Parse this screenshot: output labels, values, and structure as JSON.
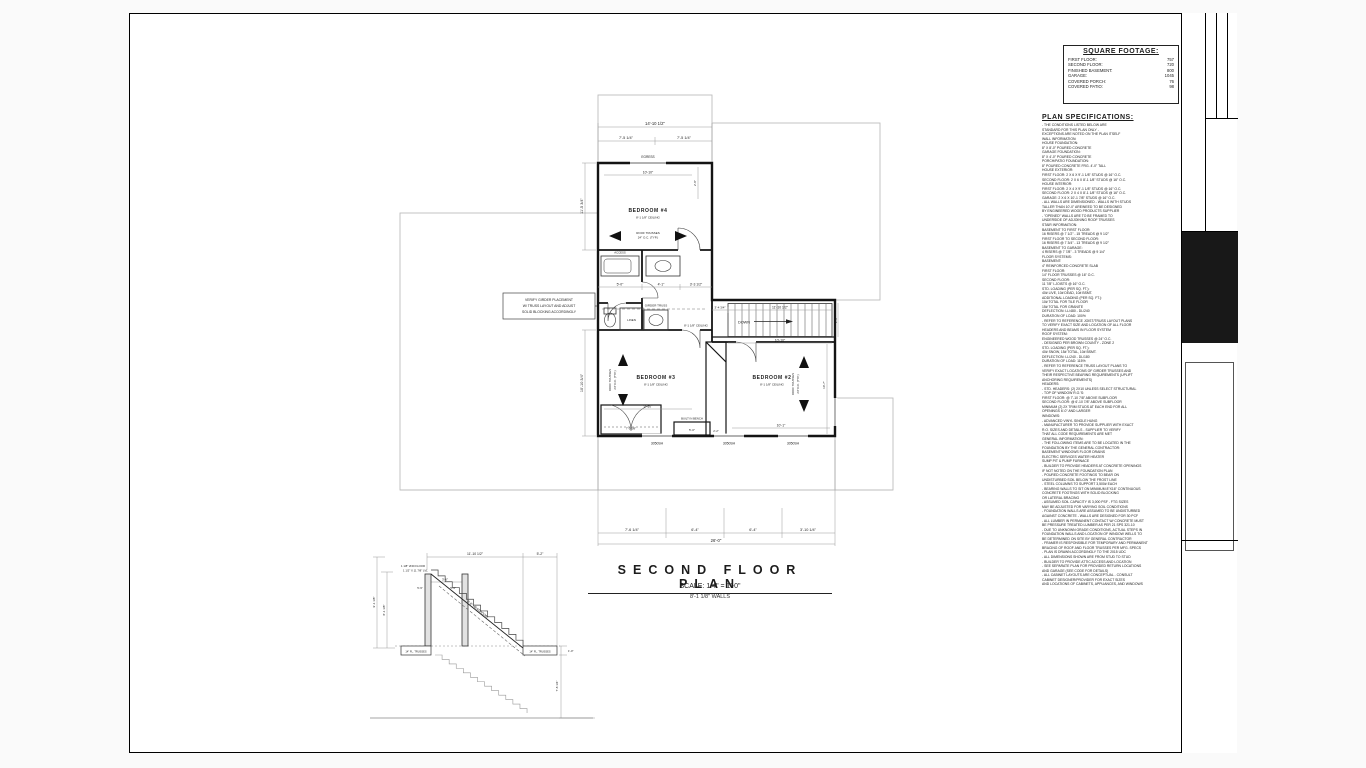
{
  "sheet": {
    "floor_plan_title": "SECOND FLOOR PLAN",
    "scale_line": "SCALE: 1/4\" = 1'-0\"",
    "walls_line": "8'-1 1/8\" WALLS"
  },
  "square_footage": {
    "title": "SQUARE FOOTAGE:",
    "rows": [
      {
        "label": "FIRST FLOOR:",
        "value": "757"
      },
      {
        "label": "SECOND FLOOR:",
        "value": "720"
      },
      {
        "label": "FINISHED BASEMENT:",
        "value": "800"
      },
      {
        "label": "GARAGE:",
        "value": "1045"
      },
      {
        "label": "COVERED PORCH:",
        "value": "76"
      },
      {
        "label": "COVERED PATIO:",
        "value": "98"
      }
    ]
  },
  "plan_specifications": {
    "title": "PLAN SPECIFICATIONS:",
    "lines": [
      "- THE CONDITIONS LISTED BELOW ARE",
      "  STANDARD FOR THIS PLAN ONLY -",
      "  EXCEPTIONS ARE NOTED ON THE PLAN ITSELF",
      "WALL INFORMATION:",
      "HOUSE FOUNDATION:",
      "   8\" X 8'-0\" POURED CONCRETE",
      "GARAGE FOUNDATION:",
      "   8\" X 4'-0\" POURED CONCRETE",
      "PORCH/PATIO FOUNDATION:",
      "   8\" POURED CONCRETE FRG. 4'-0\" TALL",
      "HOUSE EXTERIOR:",
      "   FIRST FLOOR: 2 X 6 X 9'-1 1/8\" STUDS @ 16\" O.C.",
      "   SECOND FLOOR: 2 X 6 X 8'-1 1/8\" STUDS @ 16\" O.C.",
      "HOUSE INTERIOR:",
      "   FIRST FLOOR: 2 X 4 X 9'-1 1/8\" STUDS @ 16\" O.C.",
      "   SECOND FLOOR: 2 X 4 X 8'-1 1/8\" STUDS @ 16\" O.C.",
      "GARAGE: 2 X 6 X 10'-1 7/8\" STUDS @ 16\" O.C.",
      "- ALL WALLS ARE DIMENSIONED - WALLS WITH STUDS",
      "  TALLER THAN 10'-0\" ARE/NEED TO BE DESIGNED",
      "  BY ENGINEERED WOOD PRODUCTS SUPPLIER",
      "- \"OPENED\" WALLS ARE TO BE FRAMED TO",
      "  UNDERSIDE OF ADJOINING ROOF TRUSSES",
      "STAIR INFORMATION:",
      "BASEMENT TO FIRST FLOOR:",
      "   16 RISERS @ 7 1/2\" - 15 TREADS @ 9 1/2\"",
      "FIRST FLOOR TO SECOND FLOOR:",
      "   16 RISERS @ 7 3/4\" - 13 TREADS @ 9 1/2\"",
      "BASEMENT TO GARAGE:",
      "   4 RISERS @ 7 7/8\" - 3 TREADS @ 9 1/4\"",
      "FLOOR SYSTEMS:",
      "BASEMENT:",
      "   4\" REINFORCED CONCRETE SLAB",
      "FIRST FLOOR:",
      "   14\" FLOOR TRUSSES @ 16\" O.C.",
      "SECOND FLOOR:",
      "   11 7/8\" I-JOISTS @ 16\" O.C.",
      "STD. LOADING (PER SQ. FT.):",
      "   40# LIVE, 10# DEAD, 10# BSMT.",
      "ADDITIONAL LOADING (PER SQ. FT.):",
      "   10# TOTAL FOR TILE FLOOR",
      "   15# TOTAL FOR GRANITE",
      "DEFLECTION: LL/480 - DL/240",
      "DURATION OF LOAD: 100%",
      "- REFER TO REFERENCE JOIST/TRUSS LAYOUT PLANS",
      "  TO VERIFY EXACT SIZE AND LOCATION OF ALL FLOOR",
      "  HEADERS AND BEAMS IN FLOOR SYSTEM",
      "ROOF SYSTEM:",
      "ENGINEERED WOOD TRUSSES @ 24\" O.C.",
      "   - DESIGNED PER BROWN COUNTY - ZONE 2",
      "STD. LOADING (PER SQ. FT.):",
      "   40# SNOW, 15# TOTAL, 10# BSMT.",
      "DEFLECTION: LL/240 - DL/180",
      "DURATION OF LOAD: 115%",
      "- REFER TO REFERENCE TRUSS LAYOUT PLANS TO",
      "  VERIFY EXACT LOCATIONS OF GIRDER TRUSSES AND",
      "  THEIR RESPECTIVE BEARING REQUIREMENTS (UPLIFT",
      "  ANCHORING REQUIREMENTS)",
      "HEADERS:",
      "- STD. HEADERS: (2) 2X10 UNLESS SELECT STRUCTURAL",
      "- TOP OF WINDOW R.O.'S:",
      "   FIRST FLOOR: @ 7'-10 7/8\" ABOVE SUBFLOOR",
      "   SECOND FLOOR: @ 6'-10 7/8\" ABOVE SUBFLOOR",
      "   MINIMUM (2) 2X TRIM STUDS AT EACH END FOR ALL",
      "   OPENINGS 6'-0\" AND LARGER",
      "WINDOWS:",
      "- ADVANCED VINYL SINGLE HUNG",
      "- MANUFACTURER TO PROVIDE SUPPLIER WITH EXACT",
      "  R.O. SIZES AND DETAILS - SUPPLIER TO VERIFY",
      "  THAT ALL CODE REQUIREMENTS ARE MET",
      "GENERAL INFORMATION:",
      "- THE FOLLOWING ITEMS ARE TO BE LOCATED IN THE",
      "  FOUNDATION BY THE GENERAL CONTRACTOR:",
      "   BASEMENT WINDOWS      FLOOR DRAINS",
      "   ELECTRIC SERVICES     WATER HEATER",
      "   SUMP PIT & PUMP       FURNACE",
      "- BUILDER TO PROVIDE HEADERS AT CONCRETE OPENINGS",
      "  IF NOT NOTED ON THE FOUNDATION PLAN",
      "- POURED CONCRETE FOOTINGS TO BEAR ON",
      "  UNDISTURBED SOIL BELOW THE FROST LINE",
      "- STEEL COLUMNS TO SUPPORT 3,500# EACH",
      "- BEARING WALLS TO SIT ON MINIMUM 8\"X16\" CONTINUOUS",
      "  CONCRETE FOOTINGS WITH SOLID BLOCKING",
      "  OR LATERAL BRACING",
      "- ASSUMED SOIL CAPACITY IS 3,000 PSF - FTG SIZES",
      "  MAY BE ADJUSTED FOR VARYING SOIL CONDITIONS",
      "- FOUNDATION WALLS ARE ASSUMED TO BE UNDISTURBED",
      "  AGAINST CONCRETE - WALLS ARE DESIGNED FOR 30 PCF",
      "- ALL LUMBER IN PERMANENT CONTACT W/ CONCRETE MUST",
      "  BE PRESSURE TREATED LUMBER AS PER 21 SPS 321.10",
      "- DUE TO UNKNOWN GRADE CONDITIONS, ACTUAL STEPS IN",
      "  FOUNDATION WALLS AND LOCATION OF WINDOW WELLS TO",
      "  BE DETERMINED ON SITE BY GENERAL CONTRACTOR",
      "- FRAMER IS RESPONSIBLE FOR TEMPORARY AND PERMANENT",
      "  BRACING OF ROOF AND FLOOR TRUSSES PER MFG. SPECS",
      "- PLAN IS DRAWN ACCORDINGLY TO THE 2015 UDC",
      "- ALL DIMENSIONS SHOWN ARE FROM STUD TO STUD",
      "- BUILDER TO PROVIDE ATTIC ACCESS AND LOCATION",
      "- SEE SEPARATE PLAN FOR PROVIDED RETURN LOCATIONS",
      "  AND GARAGE (SEE CODE FOR DETAILS)",
      "- ALL CABINET LAYOUTS ARE CONCEPTUAL - CONSULT",
      "  CABINET DESIGNER/PROVIDER FOR EXACT SIZES",
      "  AND LOCATIONS OF CABINETS, APPLIANCES, AND WINDOWS"
    ]
  },
  "plan": {
    "bedroom4": {
      "name": "BEDROOM #4",
      "ceiling": "8'-1 1/8\" CEILING"
    },
    "bedroom3": {
      "name": "BEDROOM #3",
      "ceiling": "8'-1 1/8\" CEILING"
    },
    "bedroom2": {
      "name": "BEDROOM #2",
      "ceiling": "8'-1 1/8\" CEILING"
    },
    "truss_note_l1": "ROOF TRUSSES",
    "truss_note_l2": "24\" O.C. (TYP.)",
    "labels": {
      "egress": "EGRESS",
      "down": "DOWN",
      "linen": "LINEN",
      "access": "ACCESS",
      "built_in_bench": "BUILT IN BENCH",
      "girder_truss": "GIRDER TRUSS",
      "hall_ceiling": "8'-1 1/8\" CEILING",
      "window_size": "3050SH",
      "verify_l1": "VERIFY GIRDER PLACEMENT",
      "verify_l2": "W/ TRUSS LAYOUT AND ADJUST",
      "verify_l3": "SOLID BLOCKING ACCORDINGLY"
    },
    "dims": {
      "top_overall": "14'-10 1/2\"",
      "top_half": "7'-5 1/4\"",
      "left_upper": "11'-5 3/4\"",
      "left_lower": "10'-10 3/4\"",
      "bed4_width": "10'-10\"",
      "bed4_right": "2'-8\"",
      "bath1": "5'-0\"",
      "bath2": "4'-1\"",
      "bath3": "3'-3 1/2\"",
      "stair_pre": "3'-4 3/4\"",
      "stair_len": "11'-10 1/2\"",
      "stair_below": "10'-10\"",
      "stair_width": "2'-8\"",
      "bed3_width": "9'-10\"",
      "bed3_closet": "7'-5 5/8\"",
      "bench_width": "5'-0\"",
      "closet_mid": "2'-2\"",
      "bed2_width": "10'-1\"",
      "bed2_right": "10'-7\"",
      "bot1": "7'-6 1/4\"",
      "bot2": "6'-4\"",
      "bot3": "6'-4\"",
      "bot4": "3'-10 1/4\"",
      "bot_overall": "26'-0\""
    }
  },
  "stair_detail": {
    "dims": {
      "run": "11'-10 1/2\"",
      "landing": "5'-2\"",
      "total_rise": "9'-1 1/8\"",
      "floor_to_floor": "8'-1 1/8\"",
      "opening": "3'-6\"",
      "post1": "5'-9\"",
      "post2": "5'-9\"",
      "nosing": "1'-0\"",
      "lower_rise": "7'-8 1/4\""
    },
    "labels": {
      "subfloor": "1 1/8\" 2ND FLOOR",
      "stringer": "1 1/2\" X 11 7/8\" LVL",
      "headroom": "6'-8\" HEADROOM",
      "truss_left": "14\" FL. TRUSSES",
      "truss_right": "14\" FL. TRUSSES"
    }
  },
  "title_block": {
    "custom_designed_for": "CUSTOM DESIGNED FOR:",
    "company": "SMART CUSTOM HOMES",
    "revisions_label": "REVISIONS",
    "revision_entry": "11-1-22",
    "job_name": "JOB NAME:  TWO STORY SPRING SHOWCASE 2011",
    "date": "DATE:  OCTOBER 18, 2022",
    "drawn_by": "DRAWN BY:  JILL VERHAAGH",
    "plan_no_label": "PLAN #:",
    "plan_no": "20-524-T",
    "logo": {
      "smart": "SMART",
      "custom_homes": "CUSTOM HOMES"
    },
    "important_note": {
      "title": "IMPORTANT NOTE:",
      "p1": "- IT IS AGREED THAT ALTHOUGH EVERY EFFORT HAS BEEN MADE IN PREPARING AND CHECKING THESE PLANS FOR ACCURACY, THE GENERAL CONTRACTOR/OWNER MUST REVIEW ALL DIMENSIONS, DETAILS AND NOTES BEFORE BEGINNING ANY CONSTRUCTION AND IS HEREBY HELD RESPONSIBLE FOR ANY DISCOVERED DISCREPANCIES.",
      "p2": "- IT IS UNDERSTOOD THAT THE WISCONSIN SAFETY AND PROFESSIONAL SERVICES CODE AND LAYOUT DRAWINGS FOR FLOOR AND ROOF TRUSSES SHALL TAKE FINAL PRECEDENCE OVER THESE ARCHITECTURAL PLANS."
    },
    "supplier": {
      "mailing": "MAILING ADDRESS:\nP.O. BOX 10307\nGREEN BAY, WI 54307-0307",
      "office": "OFFICE:\n1380 LARSEN ROAD\nGREEN BAY, WI 54303\nPHONE (920)496-5090\nFAX (920)494-5510",
      "components": "COMPONENTS:\n1745 TOWNLINE TERRACE\nGREEN BAY, WI 54303\nPHONE (920)496-5094\nFAX (920)498-9876",
      "name_w": "W",
      "name_rest": "isconsin",
      "tagline": "BUILDING SUPPLY"
    }
  }
}
